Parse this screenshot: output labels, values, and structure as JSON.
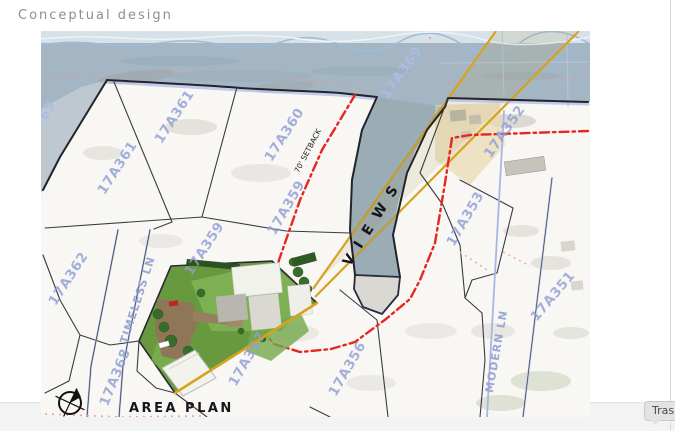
{
  "page": {
    "title": "Conceptual design",
    "tooltip_label": "Trash"
  },
  "map": {
    "legend": {
      "area_plan": "AREA PLAN"
    },
    "annotations": {
      "views": "VIEWS",
      "setback": "70' SETBACK"
    },
    "labels": [
      {
        "text": "69",
        "x": 10,
        "y": 82,
        "rot": -55,
        "kind": "water"
      },
      {
        "text": "17A369",
        "x": 364,
        "y": 44,
        "rot": -55,
        "kind": "water"
      },
      {
        "text": "17A361",
        "x": 137,
        "y": 88,
        "rot": -57,
        "kind": "parcel"
      },
      {
        "text": "17A361",
        "x": 80,
        "y": 139,
        "rot": -57,
        "kind": "parcel"
      },
      {
        "text": "17A360",
        "x": 247,
        "y": 106,
        "rot": -57,
        "kind": "parcel"
      },
      {
        "text": "17A362",
        "x": 31,
        "y": 250,
        "rot": -57,
        "kind": "parcel"
      },
      {
        "text": "17A359",
        "x": 167,
        "y": 220,
        "rot": -57,
        "kind": "parcel"
      },
      {
        "text": "17A359",
        "x": 249,
        "y": 179,
        "rot": -60,
        "kind": "parcel"
      },
      {
        "text": "17A368",
        "x": 78,
        "y": 348,
        "rot": -68,
        "kind": "parcel"
      },
      {
        "text": "17A357",
        "x": 210,
        "y": 330,
        "rot": -60,
        "kind": "parcel"
      },
      {
        "text": "17A356",
        "x": 310,
        "y": 340,
        "rot": -60,
        "kind": "parcel"
      },
      {
        "text": "17A353",
        "x": 428,
        "y": 190,
        "rot": -60,
        "kind": "parcel"
      },
      {
        "text": "17A352",
        "x": 467,
        "y": 103,
        "rot": -55,
        "kind": "parcel"
      },
      {
        "text": "17A351",
        "x": 515,
        "y": 268,
        "rot": -50,
        "kind": "parcel"
      },
      {
        "text": "TIMELESS LN",
        "x": 100,
        "y": 270,
        "rot": -72,
        "kind": "road"
      },
      {
        "text": "MODERN LN",
        "x": 459,
        "y": 321,
        "rot": -80,
        "kind": "road"
      }
    ],
    "colors": {
      "water": "#a4b6c3",
      "land": "#f8f7f4",
      "parcel_label": "#8e9ed6",
      "setback_red": "#e62621",
      "view_gold": "#d7a31e",
      "lawn_green": "#68993f",
      "boundary_ink": "#23232c"
    }
  }
}
